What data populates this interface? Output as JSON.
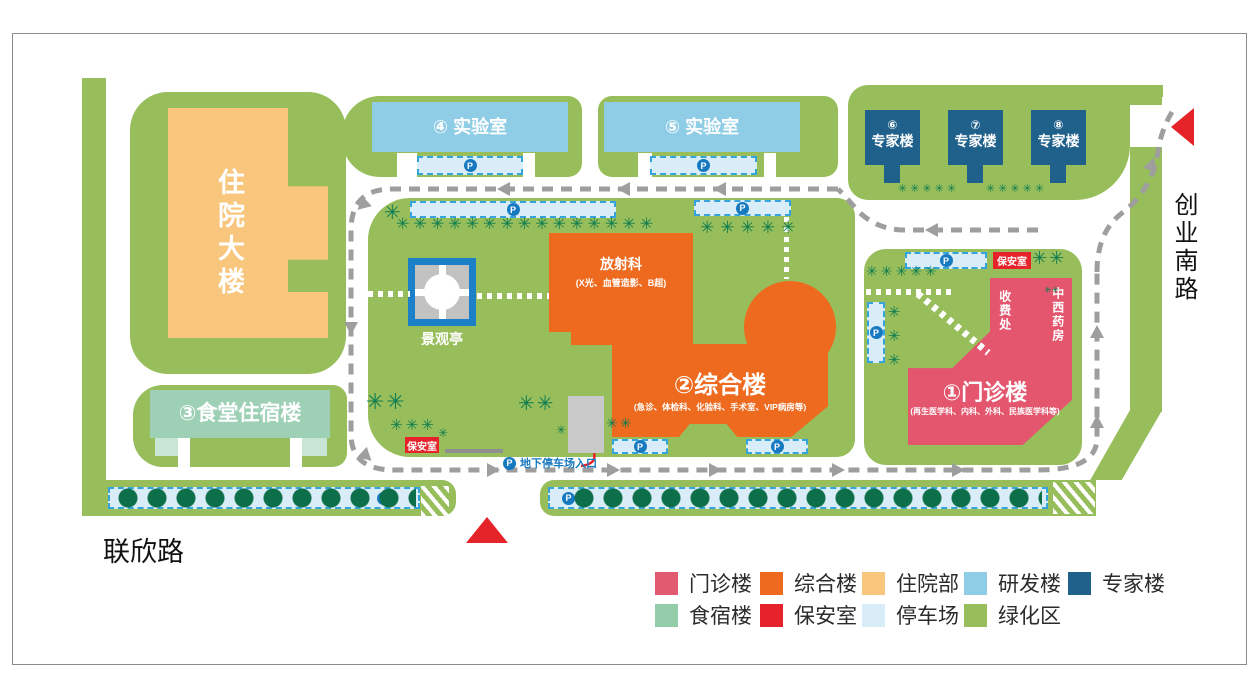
{
  "map": {
    "roads": {
      "south": "联欣路",
      "east": "创业南路"
    },
    "buildings": {
      "inpatient": {
        "label": "住院大楼"
      },
      "lab4": {
        "label": "④ 实验室"
      },
      "lab5": {
        "label": "⑤ 实验室"
      },
      "experts": [
        {
          "num": "⑥",
          "label": "专家楼"
        },
        {
          "num": "⑦",
          "label": "专家楼"
        },
        {
          "num": "⑧",
          "label": "专家楼"
        }
      ],
      "canteen": {
        "label": "③食堂住宿楼"
      },
      "radiology": {
        "label": "放射科",
        "sublabel": "(X光、血管造影、B超)"
      },
      "comprehensive": {
        "label": "②综合楼",
        "sublabel": "(急诊、体检科、化验科、手术室、VIP病房等)"
      },
      "outpatient": {
        "label": "①门诊楼",
        "sublabel": "(再生医学科、内科、外科、民族医学科等)",
        "fee": "收费处",
        "pharmacy": "中西药房"
      },
      "pavilion": {
        "label": "景观亭"
      },
      "security": {
        "label": "保安室"
      }
    },
    "parking": {
      "p": "P",
      "underground_entrance": "地下停车场入口"
    },
    "decor": {
      "palms15": "✳✳✳✳✳✳✳✳✳✳✳✳✳✳✳",
      "palms6": "✳✳✳✳✳✳",
      "palms5": "✳✳✳✳✳",
      "palms3": "✳✳✳",
      "palms2": "✳✳",
      "palm1": "✳"
    }
  },
  "legend": {
    "items": [
      {
        "label": "门诊楼",
        "color": "#E25A70"
      },
      {
        "label": "综合楼",
        "color": "#ED6A1F"
      },
      {
        "label": "住院部",
        "color": "#F9C67E"
      },
      {
        "label": "研发楼",
        "color": "#8FCDE6"
      },
      {
        "label": "专家楼",
        "color": "#20618C"
      },
      {
        "label": "食宿楼",
        "color": "#92CCA8"
      },
      {
        "label": "保安室",
        "color": "#E6232A"
      },
      {
        "label": "停车场",
        "color": "#D9EDF8"
      },
      {
        "label": "绿化区",
        "color": "#97BE5B"
      }
    ]
  }
}
